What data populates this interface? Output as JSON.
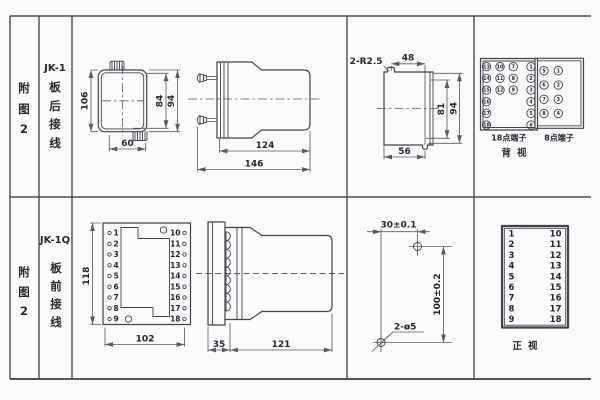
{
  "figure_caption": {
    "chars": [
      "附",
      "图",
      "2"
    ]
  },
  "row1": {
    "model": "JK-1",
    "wiring_chars": [
      "板",
      "后",
      "接",
      "线"
    ],
    "front_view": {
      "height": "106",
      "width": "60",
      "inner_height": "84",
      "outer_height": "94"
    },
    "side_view": {
      "body_depth": "124",
      "total_depth": "146"
    },
    "panel_cutout": {
      "notch_callout": "2-R2.5",
      "notch_span": "48",
      "inner_height": "81",
      "outer_height": "94",
      "width": "56"
    },
    "terminals_back": {
      "block18_label": "18点端子",
      "block8_label": "8点端子",
      "view_label": "背视",
      "block18": {
        "col1": [
          "13",
          "14",
          "15",
          "16",
          "17",
          "18"
        ],
        "col2": [
          "10",
          "11",
          "12"
        ],
        "col3": [
          "7",
          "8",
          "9"
        ],
        "col4": [
          "1",
          "2",
          "3",
          "4",
          "5",
          "6"
        ]
      },
      "block8": {
        "left": [
          "5",
          "6",
          "7",
          "8"
        ],
        "right": [
          "1",
          "2",
          "3",
          "4"
        ]
      }
    }
  },
  "row2": {
    "model": "JK-1Q",
    "wiring_chars": [
      "板",
      "前",
      "接",
      "线"
    ],
    "plate_view": {
      "height": "118",
      "width": "102"
    },
    "side_view": {
      "flange_depth": "35",
      "body_depth": "121"
    },
    "drill_pattern": {
      "h_span": "30±0.1",
      "v_span": "100±0.2",
      "holes_callout": "2-ø5"
    },
    "front_view_label": "正视",
    "terminal_numbers": {
      "left": [
        "1",
        "2",
        "3",
        "4",
        "5",
        "6",
        "7",
        "8",
        "9"
      ],
      "right": [
        "10",
        "11",
        "12",
        "13",
        "14",
        "15",
        "16",
        "17",
        "18"
      ]
    }
  }
}
